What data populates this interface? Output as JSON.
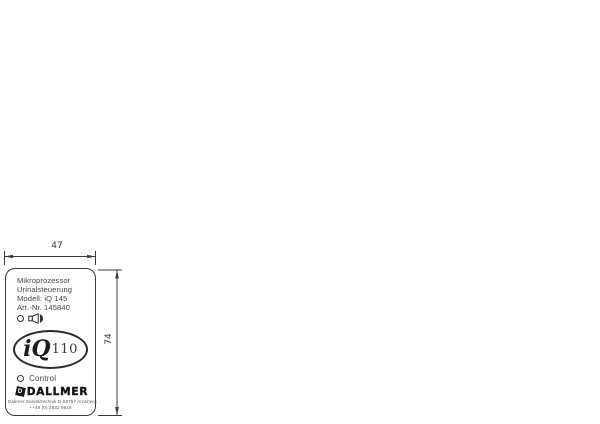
{
  "drawing": {
    "title": "Faceplate dimensioned drawing",
    "dimensions": {
      "width_label": "47",
      "height_label": "74"
    },
    "panel": {
      "line1": "Mikroprozessor",
      "line2": "Urinalsteuerung",
      "line3": "Modell: iQ 145",
      "line4": "Art.-Nr. 145840",
      "logo_text": "iQ",
      "logo_number": "110",
      "control_label": "Control",
      "brand_name": "DALLMER",
      "brand_diamond_letter": "D",
      "footer_line1": "Dallmer Sanitärtechnik D-59757 Arnsberg",
      "footer_line2": "++49 (0) 2932 9616"
    },
    "icons": [
      "led-circle-icon",
      "speaker-icon",
      "led-circle-icon",
      "brand-diamond-icon"
    ],
    "colors": {
      "line": "#3a3a3a",
      "panel_border": "#3a3a3a",
      "logo_ink": "#141414",
      "background": "#ffffff"
    }
  }
}
